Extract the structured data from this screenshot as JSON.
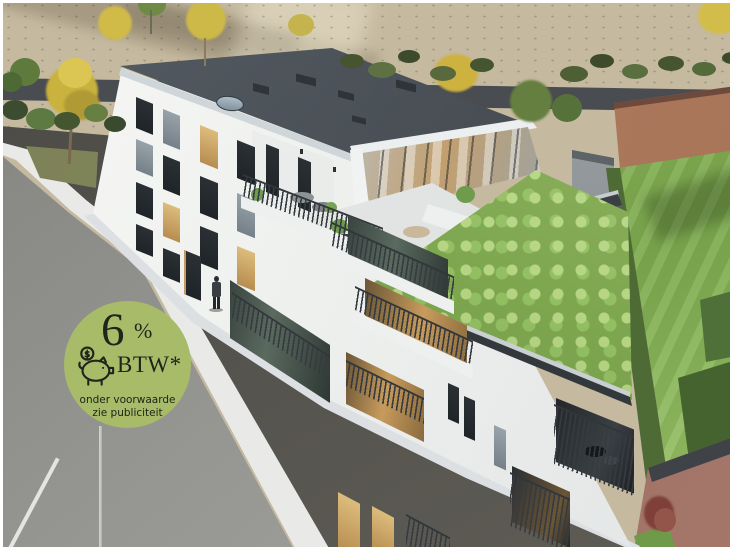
{
  "badge": {
    "rate_number": "6",
    "rate_symbol": "%",
    "tax_label": "BTW*",
    "condition_line1": "onder voorwaarde",
    "condition_line2": "zie publiciteit",
    "background_color": "#a8bb69",
    "text_color": "#20241a",
    "icon": "piggy-bank-icon"
  },
  "scene": {
    "description": "Aerial 3D architectural rendering of a modern white apartment building with a dark flat roof, penthouse terrace, sedum green roof over the lower wing, surrounding streets and sidewalks, autumn trees, a lawn with hedges, neighbouring brick buildings and a pedestrian.",
    "palette": {
      "field": "#c5b99f",
      "street": "#51504b",
      "side_road": "#8f8f8d",
      "curb": "#ebecea",
      "building": "#f2f3f1",
      "roof": "#4a5157",
      "green_roof": "#8fb95f",
      "lawn": "#88b457",
      "brick": "#a97762",
      "wall": "#46494c"
    }
  }
}
